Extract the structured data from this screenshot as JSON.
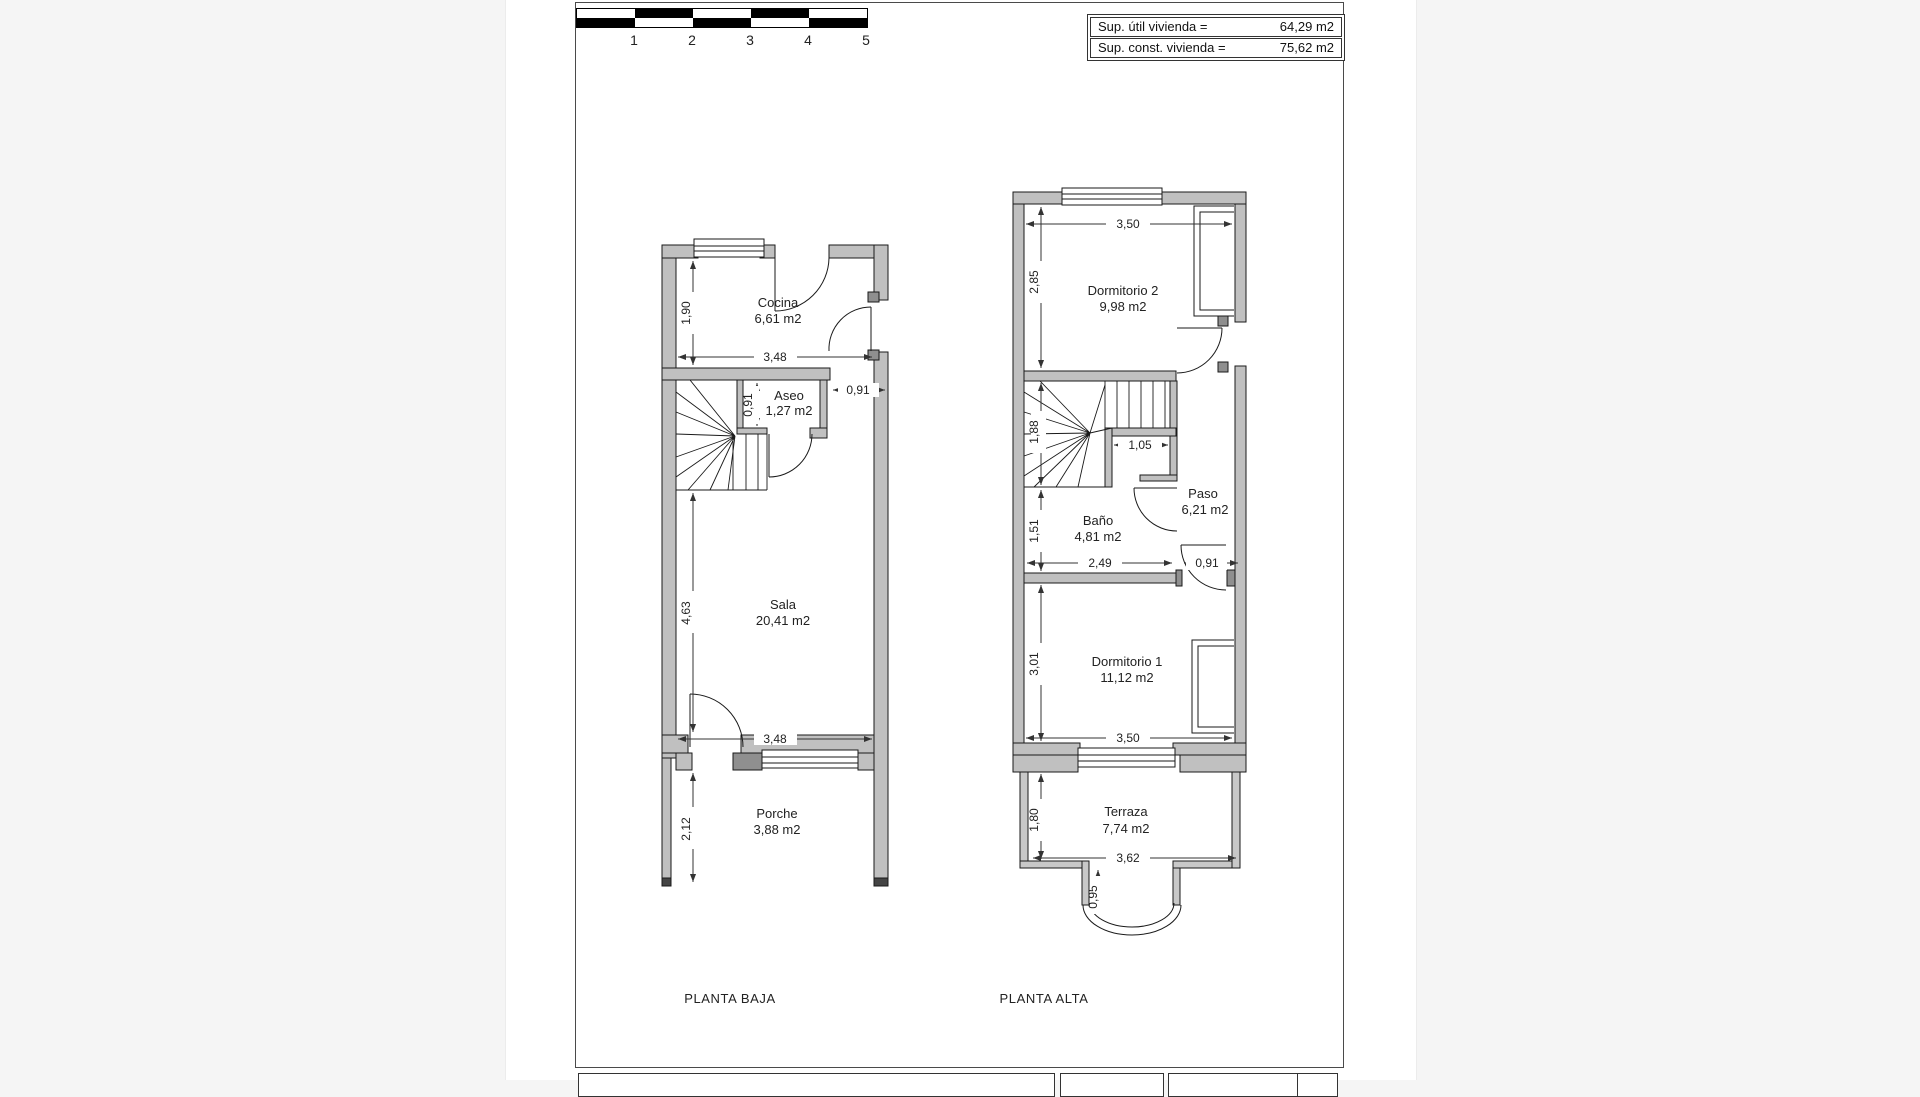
{
  "scale_bar": {
    "labels": [
      "1",
      "2",
      "3",
      "4",
      "5"
    ]
  },
  "summary_box": {
    "rows": [
      {
        "label": "Sup. útil vivienda =",
        "value": "64,29 m2"
      },
      {
        "label": "Sup. const. vivienda =",
        "value": "75,62 m2"
      }
    ]
  },
  "floors": {
    "baja": {
      "title": "PLANTA BAJA",
      "rooms": {
        "cocina": {
          "name": "Cocina",
          "area": "6,61 m2"
        },
        "aseo": {
          "name": "Aseo",
          "area": "1,27 m2"
        },
        "sala": {
          "name": "Sala",
          "area": "20,41 m2"
        },
        "porche": {
          "name": "Porche",
          "area": "3,88 m2"
        }
      },
      "dims": {
        "cocina_height": "1,90",
        "cocina_width": "3,48",
        "aseo_height": "0,91",
        "door_width": "0,91",
        "sala_height": "4,63",
        "sala_width": "3,48",
        "porche_height": "2,12"
      }
    },
    "alta": {
      "title": "PLANTA ALTA",
      "rooms": {
        "dormitorio2": {
          "name": "Dormitorio 2",
          "area": "9,98 m2"
        },
        "paso": {
          "name": "Paso",
          "area": "6,21 m2"
        },
        "bano": {
          "name": "Baño",
          "area": "4,81 m2"
        },
        "dormitorio1": {
          "name": "Dormitorio 1",
          "area": "11,12 m2"
        },
        "terraza": {
          "name": "Terraza",
          "area": "7,74 m2"
        }
      },
      "dims": {
        "dorm2_width": "3,50",
        "dorm2_height": "2,85",
        "stairs_height": "1,88",
        "nook_width": "1,05",
        "bano_height": "1,51",
        "bano_width": "2,49",
        "door_width": "0,91",
        "dorm1_height": "3,01",
        "dorm1_width": "3,50",
        "terraza_height": "1,80",
        "terraza_width": "3,62",
        "bay_depth": "0,95"
      }
    }
  },
  "colors": {
    "wall_fill": "#c0c0c0",
    "jamb_fill": "#8f8f8f",
    "line": "#1a1a1a",
    "paper": "#ffffff",
    "margin": "#f5f5f5"
  }
}
